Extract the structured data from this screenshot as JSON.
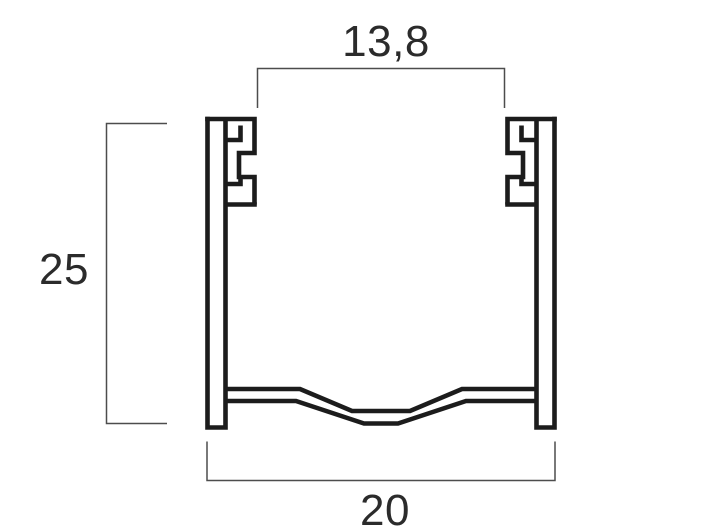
{
  "drawing": {
    "title": "profile-cross-section",
    "dimensions": {
      "top_inner_width": {
        "label": "13,8"
      },
      "height": {
        "label": "25"
      },
      "overall_width": {
        "label": "20"
      }
    },
    "colors": {
      "profile_line": "#1c1c1c",
      "dimension_line": "#4d4d4d",
      "text": "#2b2b2b",
      "background": "#ffffff"
    }
  }
}
